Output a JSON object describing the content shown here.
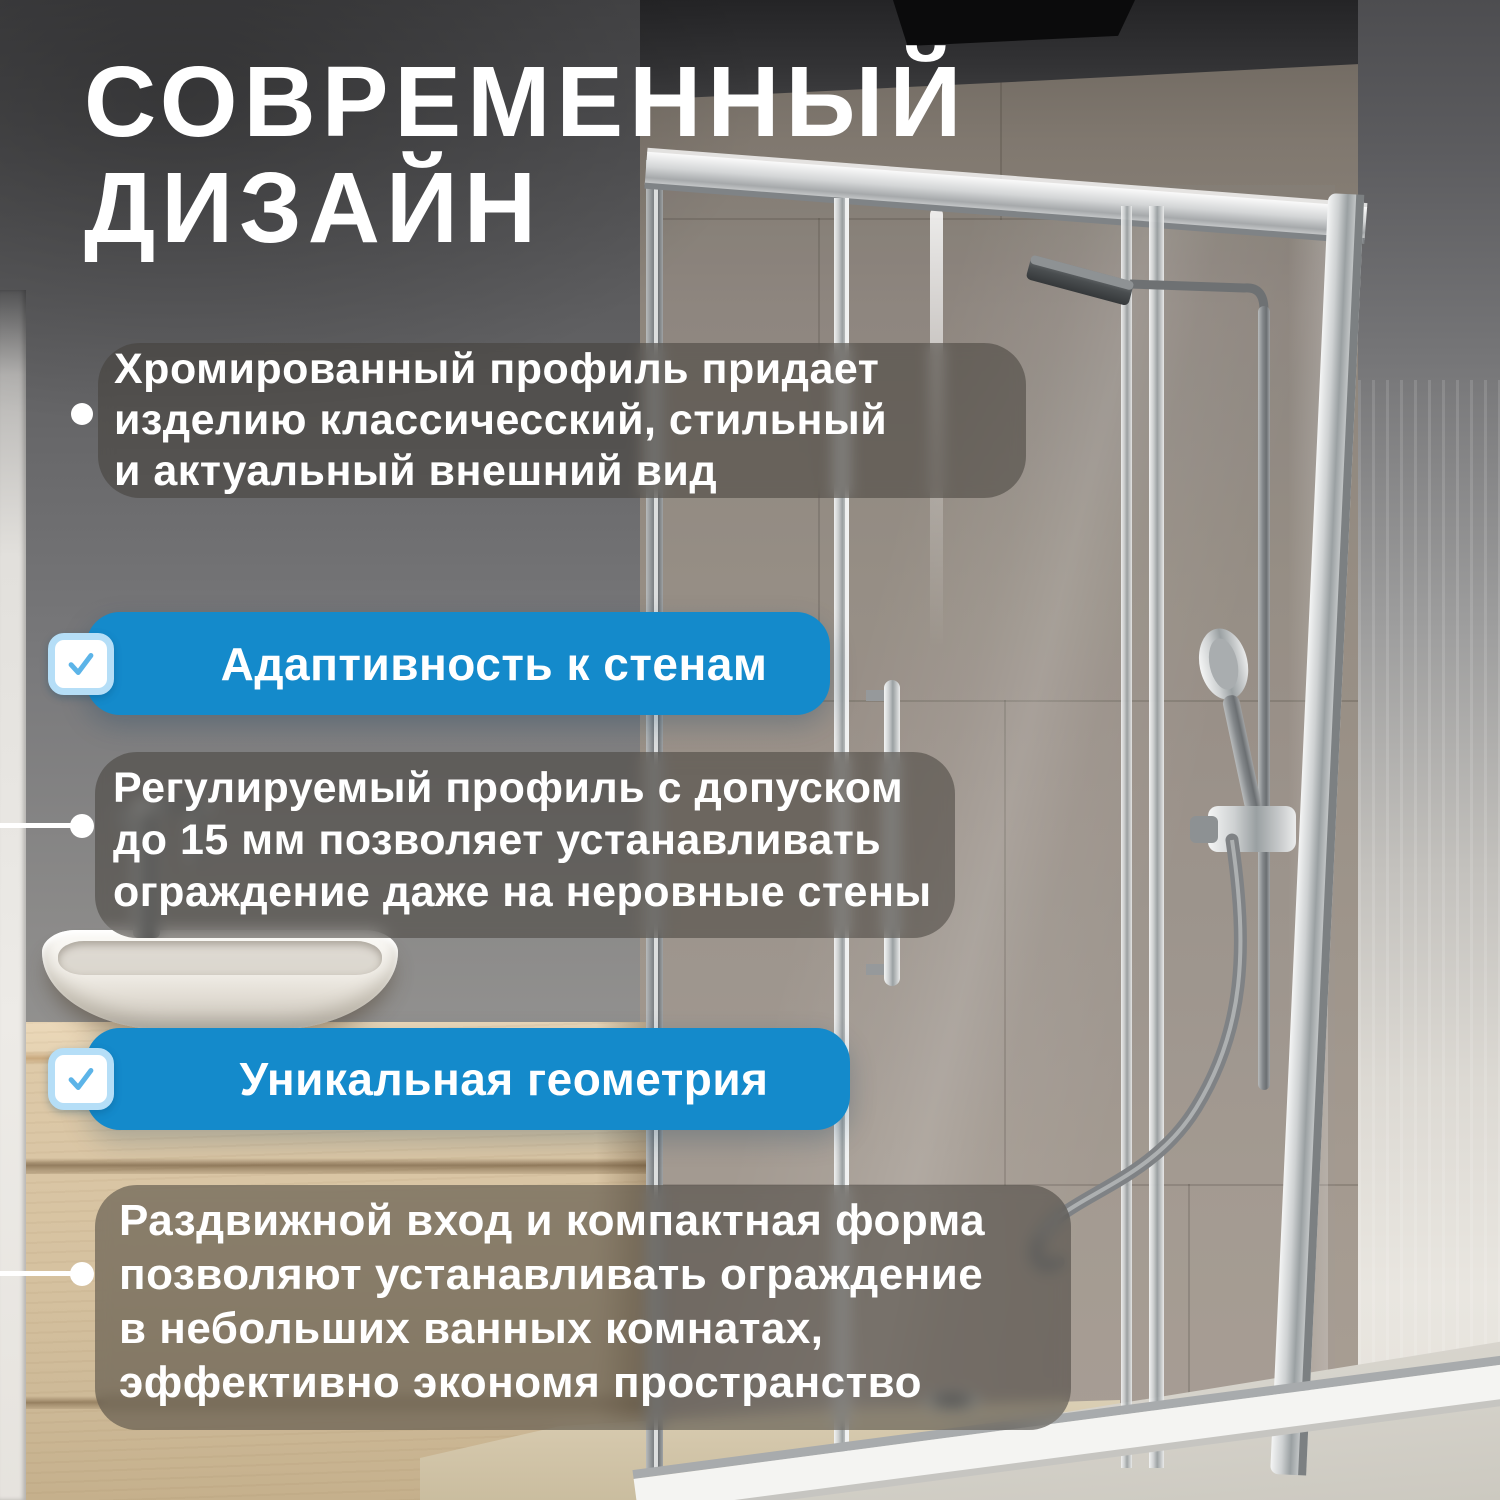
{
  "title": {
    "lines": [
      "СОВРЕМЕННЫЙ",
      "ДИЗАЙН"
    ]
  },
  "notes": [
    {
      "lines": [
        "Хромированный профиль придает",
        "изделию классичесский, стильный",
        "и актуальный внешний вид"
      ]
    },
    {
      "lines": [
        "Регулируемый профиль с допуском",
        "до 15 мм позволяет устанавливать",
        "ограждение даже на неровные стены"
      ]
    },
    {
      "lines": [
        "Раздвижной вход и компактная форма",
        "позволяют устанавливать ограждение",
        "в небольших ванных комнатах,",
        "эффективно экономя пространство"
      ]
    }
  ],
  "badges": [
    {
      "label": "Адаптивность к стенам",
      "icon": "checkmark"
    },
    {
      "label": "Уникальная геометрия",
      "icon": "checkmark"
    }
  ],
  "colors": {
    "badge_blue": "#148acb",
    "checkbox_border": "#b5def7",
    "checkmark_blue": "#5cb4e8",
    "note_overlay": "rgba(66,61,56,0.52)",
    "text_white": "#ffffff"
  }
}
